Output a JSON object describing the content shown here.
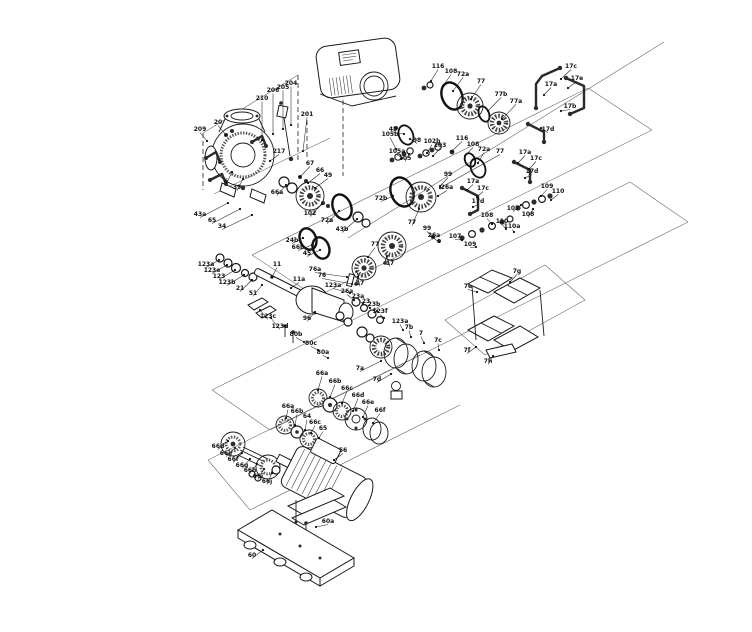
{
  "page": {
    "background": "#ffffff"
  },
  "diagram": {
    "type": "exploded-parts-diagram",
    "subject": "pump assembly exploded view with position callouts",
    "line_color": "#1a1a1a",
    "frame_color": "#6b6b6b",
    "label_color": "#111111",
    "label_font_size": 6,
    "labels": [
      {
        "t": "209",
        "x": 200,
        "y": 131,
        "tx": 207,
        "ty": 141
      },
      {
        "t": "20",
        "x": 218,
        "y": 124,
        "tx": 226,
        "ty": 135
      },
      {
        "t": "210",
        "x": 262,
        "y": 100,
        "tx": 262,
        "ty": 140
      },
      {
        "t": "206",
        "x": 273,
        "y": 92,
        "tx": 273,
        "ty": 134
      },
      {
        "t": "205",
        "x": 283,
        "y": 89,
        "tx": 283,
        "ty": 129
      },
      {
        "t": "204",
        "x": 291,
        "y": 85,
        "tx": 291,
        "ty": 125
      },
      {
        "t": "201",
        "x": 307,
        "y": 116,
        "tx": 303,
        "ty": 151
      },
      {
        "t": "217",
        "x": 279,
        "y": 153,
        "tx": 270,
        "ty": 161
      },
      {
        "t": "6",
        "x": 226,
        "y": 183,
        "tx": 232,
        "ty": 172
      },
      {
        "t": "39",
        "x": 237,
        "y": 189,
        "tx": 243,
        "ty": 179
      },
      {
        "t": "66a",
        "x": 277,
        "y": 194,
        "tx": 286,
        "ty": 185
      },
      {
        "t": "43a",
        "x": 200,
        "y": 216,
        "tx": 228,
        "ty": 203
      },
      {
        "t": "65",
        "x": 212,
        "y": 222,
        "tx": 240,
        "ty": 209
      },
      {
        "t": "34",
        "x": 222,
        "y": 228,
        "tx": 252,
        "ty": 215
      },
      {
        "t": "67",
        "x": 310,
        "y": 165,
        "tx": 300,
        "ty": 177
      },
      {
        "t": "66",
        "x": 320,
        "y": 172,
        "tx": 308,
        "ty": 183
      },
      {
        "t": "49",
        "x": 328,
        "y": 177,
        "tx": 315,
        "ty": 188
      },
      {
        "t": "48",
        "x": 393,
        "y": 131,
        "tx": 404,
        "ty": 134
      },
      {
        "t": "98",
        "x": 417,
        "y": 142,
        "tx": 410,
        "ty": 139
      },
      {
        "t": "102",
        "x": 310,
        "y": 215,
        "tx": 322,
        "ty": 204
      },
      {
        "t": "72a",
        "x": 327,
        "y": 222,
        "tx": 339,
        "ty": 211
      },
      {
        "t": "43b",
        "x": 342,
        "y": 231,
        "tx": 357,
        "ty": 219
      },
      {
        "t": "24b",
        "x": 292,
        "y": 242,
        "tx": 303,
        "ty": 238
      },
      {
        "t": "66b",
        "x": 298,
        "y": 249,
        "tx": 312,
        "ty": 245
      },
      {
        "t": "45",
        "x": 307,
        "y": 255,
        "tx": 320,
        "ty": 250
      },
      {
        "t": "105b",
        "x": 390,
        "y": 136,
        "tx": 396,
        "ty": 149
      },
      {
        "t": "105a",
        "x": 397,
        "y": 153,
        "tx": 402,
        "ty": 158
      },
      {
        "t": "105",
        "x": 405,
        "y": 160,
        "tx": 409,
        "ty": 154
      },
      {
        "t": "102b",
        "x": 432,
        "y": 143,
        "tx": 427,
        "ty": 153
      },
      {
        "t": "103",
        "x": 440,
        "y": 147,
        "tx": 433,
        "ty": 156
      },
      {
        "t": "116",
        "x": 462,
        "y": 140,
        "tx": 452,
        "ty": 151
      },
      {
        "t": "108",
        "x": 473,
        "y": 146,
        "tx": 465,
        "ty": 156
      },
      {
        "t": "72a",
        "x": 484,
        "y": 151,
        "tx": 478,
        "ty": 163
      },
      {
        "t": "77",
        "x": 500,
        "y": 153,
        "tx": 440,
        "ty": 188
      },
      {
        "t": "17a",
        "x": 525,
        "y": 154,
        "tx": 518,
        "ty": 163
      },
      {
        "t": "17c",
        "x": 536,
        "y": 160,
        "tx": 529,
        "ty": 169
      },
      {
        "t": "17d",
        "x": 532,
        "y": 173,
        "tx": 525,
        "ty": 178
      },
      {
        "t": "99",
        "x": 448,
        "y": 176,
        "tx": 440,
        "ty": 186
      },
      {
        "t": "26a",
        "x": 447,
        "y": 189,
        "tx": 438,
        "ty": 196
      },
      {
        "t": "72b",
        "x": 381,
        "y": 200,
        "tx": 393,
        "ty": 196
      },
      {
        "t": "77",
        "x": 412,
        "y": 224,
        "tx": 419,
        "ty": 209
      },
      {
        "t": "17",
        "x": 390,
        "y": 265,
        "tx": 387,
        "ty": 256
      },
      {
        "t": "77",
        "x": 375,
        "y": 246,
        "tx": 368,
        "ty": 257
      },
      {
        "t": "17",
        "x": 360,
        "y": 285,
        "tx": 358,
        "ty": 277
      },
      {
        "t": "99",
        "x": 427,
        "y": 230,
        "tx": 433,
        "ty": 237
      },
      {
        "t": "26a",
        "x": 434,
        "y": 237,
        "tx": 439,
        "ty": 242
      },
      {
        "t": "116",
        "x": 438,
        "y": 68,
        "tx": 431,
        "ty": 81
      },
      {
        "t": "108",
        "x": 451,
        "y": 73,
        "tx": 443,
        "ty": 86
      },
      {
        "t": "72a",
        "x": 463,
        "y": 76,
        "tx": 453,
        "ty": 91
      },
      {
        "t": "77",
        "x": 481,
        "y": 83,
        "tx": 471,
        "ty": 99
      },
      {
        "t": "77b",
        "x": 501,
        "y": 96,
        "tx": 488,
        "ty": 111
      },
      {
        "t": "77a",
        "x": 516,
        "y": 103,
        "tx": 502,
        "ty": 119
      },
      {
        "t": "17c",
        "x": 571,
        "y": 68,
        "tx": 561,
        "ty": 79
      },
      {
        "t": "17e",
        "x": 577,
        "y": 80,
        "tx": 568,
        "ty": 88
      },
      {
        "t": "17a",
        "x": 551,
        "y": 86,
        "tx": 544,
        "ty": 95
      },
      {
        "t": "17b",
        "x": 570,
        "y": 108,
        "tx": 561,
        "ty": 111
      },
      {
        "t": "17d",
        "x": 548,
        "y": 131,
        "tx": 541,
        "ty": 128
      },
      {
        "t": "17a",
        "x": 473,
        "y": 183,
        "tx": 467,
        "ty": 190
      },
      {
        "t": "17c",
        "x": 483,
        "y": 190,
        "tx": 477,
        "ty": 197
      },
      {
        "t": "17d",
        "x": 478,
        "y": 203,
        "tx": 473,
        "ty": 207
      },
      {
        "t": "109",
        "x": 547,
        "y": 188,
        "tx": 541,
        "ty": 196
      },
      {
        "t": "110",
        "x": 558,
        "y": 193,
        "tx": 551,
        "ty": 200
      },
      {
        "t": "107",
        "x": 513,
        "y": 210,
        "tx": 521,
        "ty": 205
      },
      {
        "t": "108",
        "x": 528,
        "y": 216,
        "tx": 533,
        "ty": 209
      },
      {
        "t": "108",
        "x": 487,
        "y": 217,
        "tx": 492,
        "ty": 224
      },
      {
        "t": "110",
        "x": 502,
        "y": 223,
        "tx": 506,
        "ty": 229
      },
      {
        "t": "110a",
        "x": 512,
        "y": 228,
        "tx": 514,
        "ty": 232
      },
      {
        "t": "107",
        "x": 455,
        "y": 238,
        "tx": 462,
        "ty": 240
      },
      {
        "t": "109",
        "x": 470,
        "y": 246,
        "tx": 476,
        "ty": 247
      },
      {
        "t": "26a",
        "x": 347,
        "y": 293,
        "tx": 354,
        "ty": 300
      },
      {
        "t": "23a",
        "x": 358,
        "y": 298,
        "tx": 363,
        "ty": 304
      },
      {
        "t": "23",
        "x": 366,
        "y": 303,
        "tx": 370,
        "ty": 308
      },
      {
        "t": "23b",
        "x": 374,
        "y": 306,
        "tx": 377,
        "ty": 311
      },
      {
        "t": "123f",
        "x": 380,
        "y": 313,
        "tx": 384,
        "ty": 318
      },
      {
        "t": "123a",
        "x": 400,
        "y": 323,
        "tx": 403,
        "ty": 330
      },
      {
        "t": "7b",
        "x": 409,
        "y": 329,
        "tx": 411,
        "ty": 337
      },
      {
        "t": "7",
        "x": 421,
        "y": 335,
        "tx": 424,
        "ty": 343
      },
      {
        "t": "7c",
        "x": 438,
        "y": 342,
        "tx": 439,
        "ty": 350
      },
      {
        "t": "7a",
        "x": 360,
        "y": 370,
        "tx": 381,
        "ty": 361
      },
      {
        "t": "7d",
        "x": 377,
        "y": 381,
        "tx": 391,
        "ty": 374
      },
      {
        "t": "7g",
        "x": 517,
        "y": 273,
        "tx": 510,
        "ty": 282
      },
      {
        "t": "7e",
        "x": 468,
        "y": 288,
        "tx": 477,
        "ty": 292
      },
      {
        "t": "7f",
        "x": 467,
        "y": 352,
        "tx": 476,
        "ty": 347
      },
      {
        "t": "7h",
        "x": 488,
        "y": 363,
        "tx": 493,
        "ty": 356
      },
      {
        "t": "123a",
        "x": 206,
        "y": 266,
        "tx": 219,
        "ty": 260
      },
      {
        "t": "123e",
        "x": 212,
        "y": 272,
        "tx": 227,
        "ty": 265
      },
      {
        "t": "123",
        "x": 219,
        "y": 278,
        "tx": 235,
        "ty": 270
      },
      {
        "t": "123b",
        "x": 227,
        "y": 284,
        "tx": 244,
        "ty": 275
      },
      {
        "t": "21",
        "x": 240,
        "y": 290,
        "tx": 252,
        "ty": 280
      },
      {
        "t": "51",
        "x": 253,
        "y": 295,
        "tx": 262,
        "ty": 285
      },
      {
        "t": "11",
        "x": 277,
        "y": 266,
        "tx": 272,
        "ty": 277
      },
      {
        "t": "11a",
        "x": 299,
        "y": 281,
        "tx": 291,
        "ty": 288
      },
      {
        "t": "76a",
        "x": 315,
        "y": 271,
        "tx": 347,
        "ty": 277
      },
      {
        "t": "76",
        "x": 322,
        "y": 277,
        "tx": 352,
        "ty": 284
      },
      {
        "t": "123a",
        "x": 333,
        "y": 287,
        "tx": 350,
        "ty": 293
      },
      {
        "t": "123c",
        "x": 268,
        "y": 318,
        "tx": 260,
        "ty": 310
      },
      {
        "t": "123d",
        "x": 280,
        "y": 328,
        "tx": 271,
        "ty": 318
      },
      {
        "t": "96",
        "x": 307,
        "y": 320,
        "tx": 315,
        "ty": 312
      },
      {
        "t": "80b",
        "x": 296,
        "y": 336,
        "tx": 304,
        "ty": 342
      },
      {
        "t": "80c",
        "x": 311,
        "y": 345,
        "tx": 318,
        "ty": 350
      },
      {
        "t": "80a",
        "x": 323,
        "y": 354,
        "tx": 328,
        "ty": 358
      },
      {
        "t": "66a",
        "x": 322,
        "y": 375,
        "tx": 318,
        "ty": 390
      },
      {
        "t": "66b",
        "x": 335,
        "y": 383,
        "tx": 330,
        "ty": 397
      },
      {
        "t": "66c",
        "x": 347,
        "y": 390,
        "tx": 342,
        "ty": 403
      },
      {
        "t": "66d",
        "x": 358,
        "y": 397,
        "tx": 353,
        "ty": 411
      },
      {
        "t": "66e",
        "x": 368,
        "y": 404,
        "tx": 363,
        "ty": 417
      },
      {
        "t": "66f",
        "x": 380,
        "y": 412,
        "tx": 373,
        "ty": 423
      },
      {
        "t": "66a",
        "x": 288,
        "y": 408,
        "tx": 286,
        "ty": 418
      },
      {
        "t": "66b",
        "x": 297,
        "y": 413,
        "tx": 295,
        "ty": 425
      },
      {
        "t": "64",
        "x": 307,
        "y": 418,
        "tx": 305,
        "ty": 430
      },
      {
        "t": "66c",
        "x": 315,
        "y": 424,
        "tx": 311,
        "ty": 433
      },
      {
        "t": "65",
        "x": 323,
        "y": 430,
        "tx": 319,
        "ty": 438
      },
      {
        "t": "66d",
        "x": 218,
        "y": 448,
        "tx": 228,
        "ty": 441
      },
      {
        "t": "66e",
        "x": 226,
        "y": 455,
        "tx": 235,
        "ty": 448
      },
      {
        "t": "66f",
        "x": 233,
        "y": 461,
        "tx": 242,
        "ty": 453
      },
      {
        "t": "66g",
        "x": 242,
        "y": 467,
        "tx": 250,
        "ty": 459
      },
      {
        "t": "66h",
        "x": 250,
        "y": 472,
        "tx": 257,
        "ty": 464
      },
      {
        "t": "66i",
        "x": 258,
        "y": 478,
        "tx": 264,
        "ty": 469
      },
      {
        "t": "66j",
        "x": 267,
        "y": 483,
        "tx": 272,
        "ty": 473
      },
      {
        "t": "56",
        "x": 343,
        "y": 452,
        "tx": 334,
        "ty": 460
      },
      {
        "t": "60a",
        "x": 328,
        "y": 523,
        "tx": 316,
        "ty": 527
      },
      {
        "t": "60",
        "x": 252,
        "y": 557,
        "tx": 263,
        "ty": 550
      }
    ]
  }
}
